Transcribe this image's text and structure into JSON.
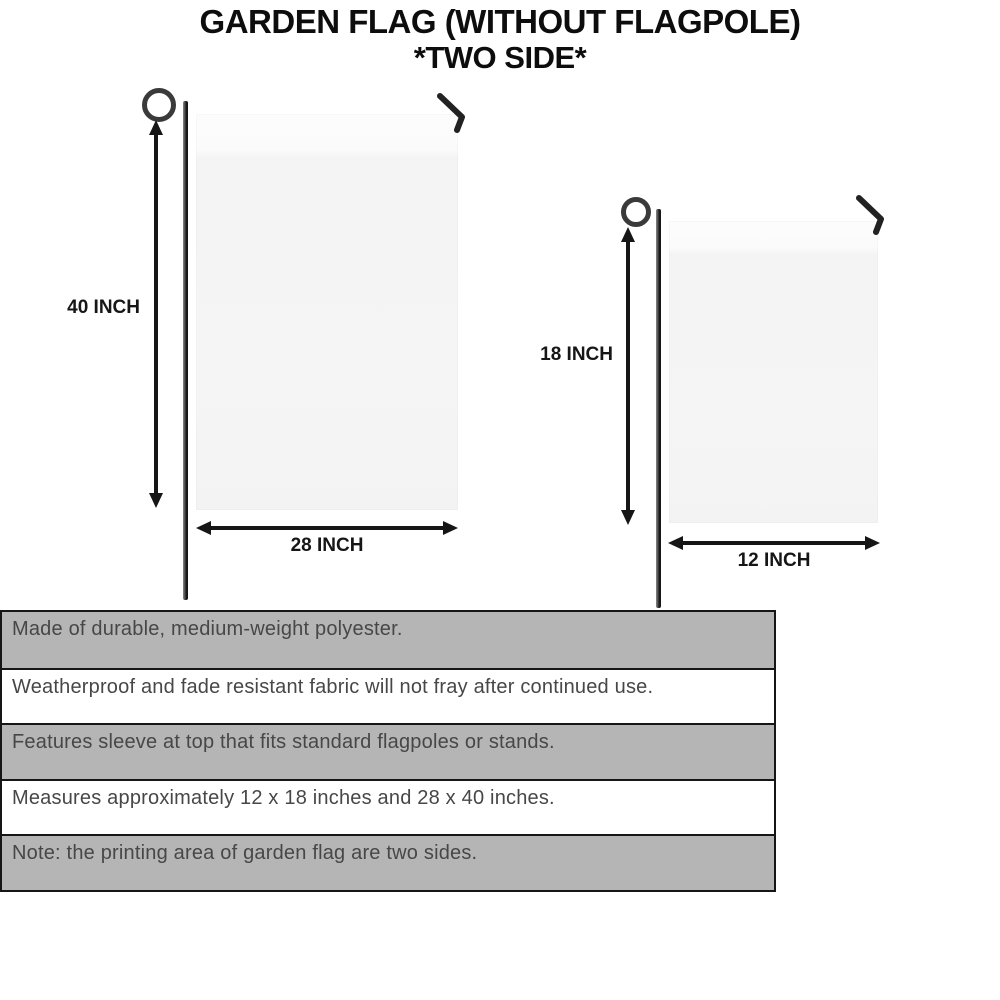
{
  "title": {
    "line1": "GARDEN FLAG (WITHOUT FLAGPOLE)",
    "line2": "*TWO SIDE*"
  },
  "figures": {
    "large": {
      "height_label": "40 INCH",
      "width_label": "28 INCH"
    },
    "small": {
      "height_label": "18 INCH",
      "width_label": "12 INCH"
    }
  },
  "features": [
    "Made of durable, medium-weight polyester.",
    "Weatherproof and fade resistant fabric will not fray after continued use.",
    "Features sleeve at top that fits standard flagpoles or stands.",
    "Measures approximately 12 x 18 inches and 28 x 40 inches.",
    "Note: the printing area of garden flag are two sides."
  ],
  "colors": {
    "row_gray": "#b5b5b5",
    "row_white": "#ffffff",
    "table_border": "#161616",
    "flag_fill": "#f5f5f5",
    "pole_dark": "#161616",
    "title_text": "#0d0d0d",
    "feature_text": "#474747"
  }
}
